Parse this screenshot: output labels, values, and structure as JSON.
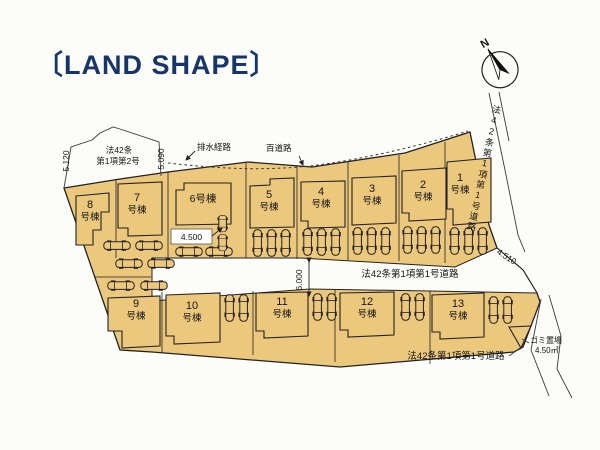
{
  "title": "〔LAND SHAPE〕",
  "compass": {
    "label": "N"
  },
  "colors": {
    "land": "#ecc87d",
    "outline": "#222222",
    "title_text": "#17356d",
    "background": "#fcfcf8"
  },
  "plots": [
    {
      "n": "1",
      "s": "号棟"
    },
    {
      "n": "2",
      "s": "号棟"
    },
    {
      "n": "3",
      "s": "号棟"
    },
    {
      "n": "4",
      "s": "号棟"
    },
    {
      "n": "5",
      "s": "号棟"
    },
    {
      "n": "6号棟",
      "s": ""
    },
    {
      "n": "7",
      "s": "号棟"
    },
    {
      "n": "8",
      "s": "号棟"
    },
    {
      "n": "9",
      "s": "号棟"
    },
    {
      "n": "10",
      "s": "号棟"
    },
    {
      "n": "11",
      "s": "号棟"
    },
    {
      "n": "12",
      "s": "号棟"
    },
    {
      "n": "13",
      "s": "号棟"
    }
  ],
  "annotations": {
    "law_top_left_1": "法42条",
    "law_top_left_2": "第1項第2号",
    "dim_left": "5.120",
    "dim_top": "5.090",
    "drainage_route": "排水経路",
    "top_road": "百道路",
    "dim_parking": "4.500",
    "dim_right": "4.510",
    "dim_road_width": "6.000",
    "road_center": "法42条第1項第1号道路",
    "road_right": "法42条第1項第1号道路",
    "road_bottom": "法42条第1項第1号道路",
    "garbage_name": "ゴミ置場",
    "garbage_area": "4.50㎡"
  },
  "icons": {
    "compass": "compass-icon",
    "car": "car-icon"
  }
}
